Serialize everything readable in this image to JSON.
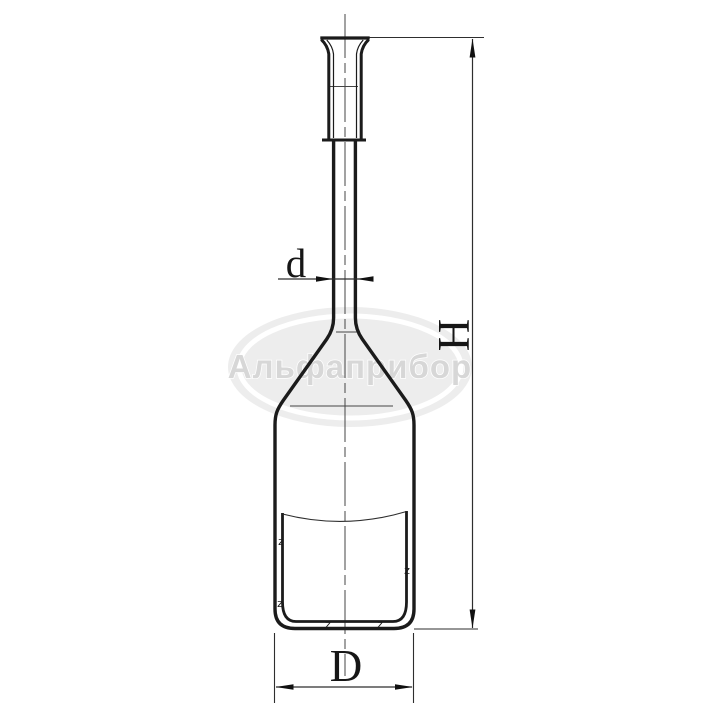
{
  "drawing": {
    "dimension_labels": {
      "d": "d",
      "H": "H",
      "D": "D"
    },
    "watermark": {
      "text": "Альфаприбор"
    },
    "hatch_glyph": "z",
    "colors": {
      "background": "#ffffff",
      "outline": "#1b1b1b",
      "thin_line": "#2e2e2e",
      "centerline": "#454545",
      "watermark_fill": "#ededed",
      "watermark_ring": "#ffffff",
      "watermark_text": "#d7d7d7"
    }
  }
}
